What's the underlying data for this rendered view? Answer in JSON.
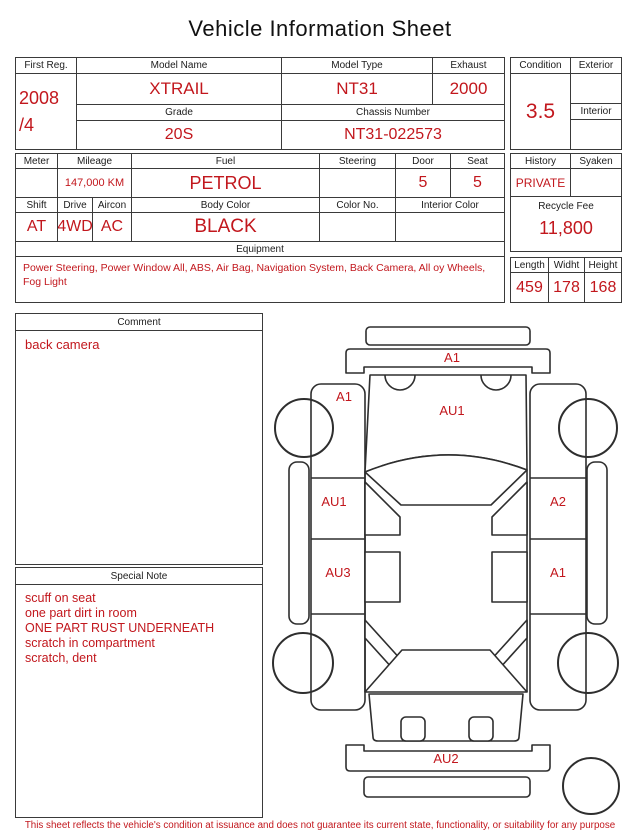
{
  "title": "Vehicle Information Sheet",
  "colors": {
    "accent_red": "#c2171d",
    "line": "#3a3a3a"
  },
  "vehicle": {
    "first_reg": {
      "label": "First Reg.",
      "line1": "2008",
      "line2": "/4"
    },
    "model_name": {
      "label": "Model Name",
      "value": "XTRAIL"
    },
    "model_type": {
      "label": "Model Type",
      "value": "NT31"
    },
    "exhaust": {
      "label": "Exhaust",
      "value": "2000"
    },
    "grade": {
      "label": "Grade",
      "value": "20S"
    },
    "chassis_number": {
      "label": "Chassis Number",
      "value": "NT31-022573"
    },
    "condition": {
      "label": "Condition",
      "value": "3.5"
    },
    "exterior": {
      "label": "Exterior",
      "value": ""
    },
    "interior": {
      "label": "Interior",
      "value": ""
    },
    "meter": {
      "label": "Meter",
      "value": ""
    },
    "mileage": {
      "label": "Mileage",
      "value": "147,000 KM"
    },
    "fuel": {
      "label": "Fuel",
      "value": "PETROL"
    },
    "steering": {
      "label": "Steering",
      "value": ""
    },
    "door": {
      "label": "Door",
      "value": "5"
    },
    "seat": {
      "label": "Seat",
      "value": "5"
    },
    "history": {
      "label": "History",
      "value": "PRIVATE"
    },
    "syaken": {
      "label": "Syaken",
      "value": ""
    },
    "shift": {
      "label": "Shift",
      "value": "AT"
    },
    "drive": {
      "label": "Drive",
      "value": "4WD"
    },
    "aircon": {
      "label": "Aircon",
      "value": "AC"
    },
    "body_color": {
      "label": "Body Color",
      "value": "BLACK"
    },
    "color_no": {
      "label": "Color No.",
      "value": ""
    },
    "interior_color": {
      "label": "Interior Color",
      "value": ""
    },
    "recycle_fee": {
      "label": "Recycle Fee",
      "value": "11,800"
    },
    "equipment": {
      "label": "Equipment",
      "line1": "Power Steering, Power Window  All, ABS, Air Bag, Navigation System, Back Camera, All",
      "line2": "oy Wheels, Fog Light"
    },
    "length": {
      "label": "Length",
      "value": "459"
    },
    "width": {
      "label": "Widht",
      "value": "178"
    },
    "height": {
      "label": "Height",
      "value": "168"
    }
  },
  "comment": {
    "label": "Comment",
    "text": "back camera"
  },
  "special_note": {
    "label": "Special Note",
    "lines": [
      "scuff on seat",
      "one part dirt in room",
      "ONE PART RUST UNDERNEATH",
      "scratch in compartment",
      "scratch, dent"
    ]
  },
  "diagram": {
    "labels": {
      "front_bumper": "A1",
      "left_front_fender": "A1",
      "hood": "AU1",
      "left_front_door": "AU1",
      "left_rear_door": "AU3",
      "right_front_door": "A2",
      "right_rear_door": "A1",
      "rear_bumper": "AU2"
    }
  },
  "footer": {
    "disclaimer": "This sheet reflects the vehicle's condition at issuance and does not guarantee its current state, functionality, or suitability for any purpose"
  }
}
